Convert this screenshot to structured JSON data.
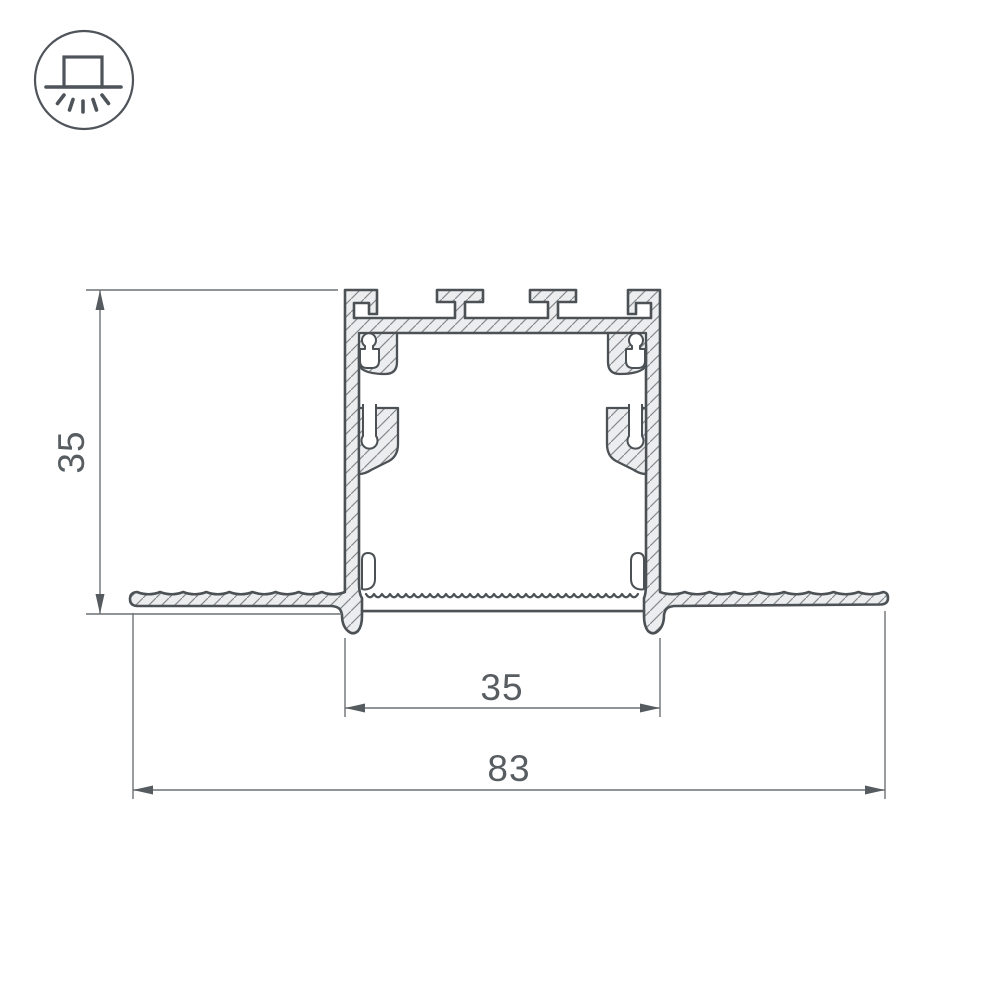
{
  "drawing": {
    "kind": "profile-cross-section"
  },
  "icon": {
    "name": "recessed-mount-luminaire-icon",
    "parts": [
      "fixture-box",
      "mounting-surface-line",
      "downward-light-rays"
    ]
  },
  "dimensions": {
    "height": {
      "label": "35"
    },
    "inner_width": {
      "label": "35"
    },
    "overall_width": {
      "label": "83"
    }
  },
  "colors": {
    "background": "#ffffff",
    "outline": "#4b5155",
    "metal_fill": "#ecedee",
    "hatch_line": "#84898d",
    "dimension_line": "#6d7276",
    "dimension_text": "#585d61",
    "icon_stroke": "#4e545a"
  }
}
